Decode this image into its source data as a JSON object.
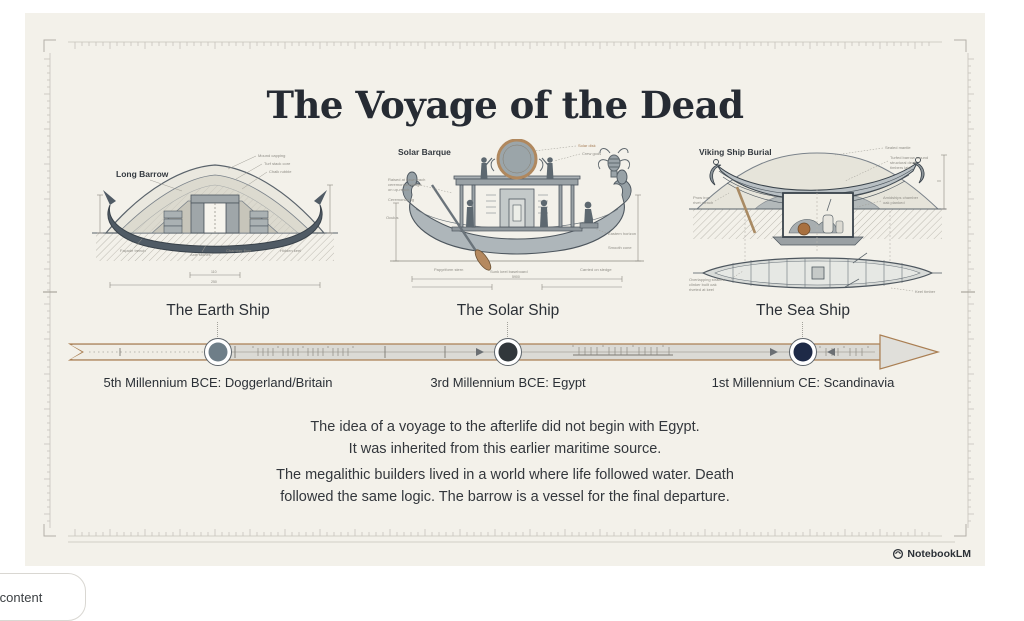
{
  "page": {
    "background": "#ffffff",
    "canvas_bg": "#f3f1ea",
    "accent_tan": "#aa7f53"
  },
  "title": "The Voyage of the Dead",
  "illustrations": [
    {
      "label": "Long Barrow",
      "annotations": [
        "Mound capping",
        "Turf stack core",
        "Chalk rubble",
        "Façade trench",
        "Axle stones",
        "Chamber floor",
        "Hidden keel",
        "110",
        "250"
      ]
    },
    {
      "label": "Solar Barque",
      "annotations": [
        "Solar disk",
        "Crew gods",
        "Raised at dawn each",
        "ceremonial voyage",
        "on up-reach",
        "Ceremonial rig",
        "Oculus",
        "Papyriform stern",
        "Sunk keel baseboard",
        "Carried on sledge",
        "Eastern horizon",
        "Smooth cone",
        "5900"
      ]
    },
    {
      "label": "Viking Ship Burial",
      "annotations": [
        "Sealed mantle",
        "Turfed barrow mound",
        "structural deck",
        "timbers laid",
        "Amidships chamber",
        "oak planked",
        "Prow iron",
        "rivet clench",
        "Overlapping strakes",
        "clinker built oak",
        "riveted at keel",
        "Keel timber"
      ]
    }
  ],
  "timeline": {
    "band_outline": "#aa7f53",
    "band_fill": "#dbdad5",
    "items": [
      {
        "title": "The Earth Ship",
        "caption": "5th Millennium BCE: Doggerland/Britain",
        "node_color": "#6e7e88"
      },
      {
        "title": "The Solar Ship",
        "caption": "3rd Millennium BCE: Egypt",
        "node_color": "#31373b"
      },
      {
        "title": "The Sea Ship",
        "caption": "1st Millennium CE: Scandinavia",
        "node_color": "#1e2a47"
      }
    ]
  },
  "paragraphs": [
    {
      "lines": [
        "The idea of a voyage to the afterlife did not begin with Egypt.",
        "It was inherited from this earlier maritime source."
      ]
    },
    {
      "lines": [
        "The megalithic builders lived in a world where life followed water. Death",
        "followed the same logic. The barrow is a vessel for the final departure."
      ]
    }
  ],
  "footer": {
    "brand": "NotebookLM"
  },
  "chip": {
    "label": "content"
  }
}
